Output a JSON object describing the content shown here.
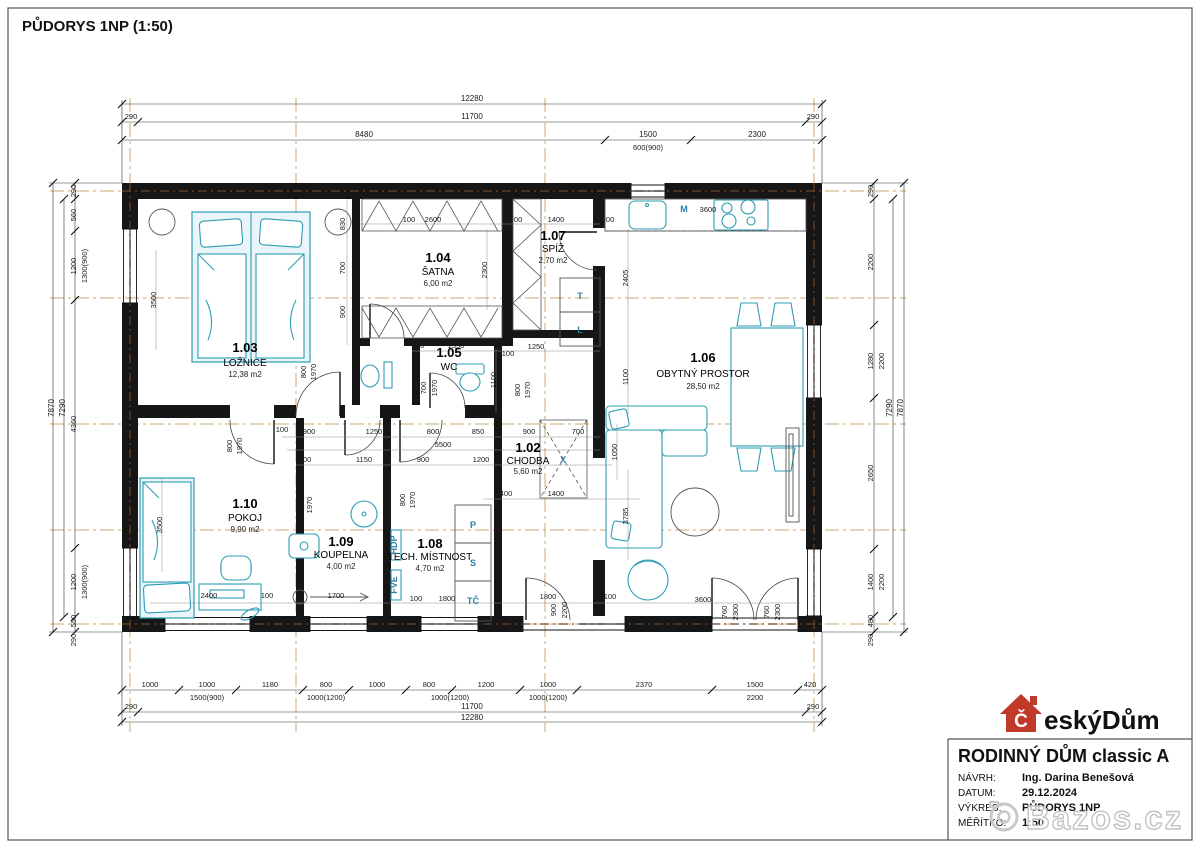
{
  "page": {
    "title": "PŮDORYS 1NP (1:50)"
  },
  "rooms": [
    {
      "num": "1.02",
      "name": "CHODBA",
      "area": "5,60 m2"
    },
    {
      "num": "1.03",
      "name": "LOŽNICE",
      "area": "12,38 m2"
    },
    {
      "num": "1.04",
      "name": "ŠATNA",
      "area": "6,00 m2"
    },
    {
      "num": "1.05",
      "name": "WC",
      "area": ""
    },
    {
      "num": "1.06",
      "name": "OBYTNÝ PROSTOR",
      "area": "28,50 m2"
    },
    {
      "num": "1.07",
      "name": "SPÍŽ",
      "area": "2,70 m2"
    },
    {
      "num": "1.08",
      "name": "TECH. MÍSTNOST",
      "area": "4,70 m2"
    },
    {
      "num": "1.09",
      "name": "KOUPELNA",
      "area": "4,00 m2"
    },
    {
      "num": "1.10",
      "name": "POKOJ",
      "area": "9,90 m2"
    }
  ],
  "equipment": {
    "m": "M",
    "t": "T",
    "l": "L",
    "p": "P",
    "s": "S",
    "tc": "TČ",
    "hdp": "HDP",
    "fve": "FVE",
    "x": "X"
  },
  "dims": {
    "top": {
      "overall": "12280",
      "side_l": "290",
      "inner": "11700",
      "side_r": "290",
      "segs": [
        "8480",
        "1500",
        "2300"
      ],
      "win": "600(900)"
    },
    "bottom": {
      "segs": [
        "1000",
        "1000",
        "1180",
        "800",
        "1000",
        "800",
        "1200",
        "1000",
        "2370",
        "1500",
        "420"
      ],
      "wins": [
        "1500(900)",
        "1000(1200)",
        "1000(1200)",
        "1000(1200)",
        "2200"
      ],
      "side_l": "290",
      "inner": "11700",
      "side_r": "290",
      "overall": "12280"
    },
    "left": {
      "segs": [
        "290",
        "560",
        "1200",
        "4360",
        "1200",
        "550",
        "290"
      ],
      "wins": [
        "1300(900)",
        "1300(900)"
      ],
      "inner": "7290",
      "overall": "7870"
    },
    "right": {
      "segs": [
        "290",
        "2200",
        "1280",
        "2650",
        "1400",
        "480",
        "290"
      ],
      "wins": [
        "2200",
        "2200"
      ],
      "inner": "7290",
      "overall": "7870"
    },
    "inner": [
      "2600",
      "1400",
      "100",
      "100",
      "100",
      "2300",
      "830",
      "700",
      "900",
      "3500",
      "3600",
      "2405",
      "1100",
      "1250",
      "100",
      "1550",
      "100",
      "1100",
      "900",
      "1250",
      "800",
      "850",
      "900",
      "700",
      "5500",
      "800",
      "1150",
      "900",
      "1200",
      "1050",
      "400",
      "1400",
      "800",
      "1970",
      "700",
      "1970",
      "800",
      "1970",
      "800",
      "1970",
      "800",
      "1970",
      "700",
      "1970",
      "900",
      "2200",
      "760",
      "2300",
      "760",
      "2300",
      "1800",
      "100",
      "1800",
      "100",
      "1700",
      "2400",
      "100",
      "3600",
      "3785",
      "3500",
      "100"
    ]
  },
  "title_block": {
    "project": "RODINNÝ DŮM classic A",
    "rows": [
      {
        "label": "NÁVRH:",
        "value": "Ing. Darina Benešová"
      },
      {
        "label": "DATUM:",
        "value": "29.12.2024"
      },
      {
        "label": "VÝKRES:",
        "value": "PŮDORYS 1NP"
      },
      {
        "label": "MĚŘÍTKO:",
        "value": "1:50"
      }
    ]
  },
  "logo": {
    "initial": "Č",
    "rest": "eskýDům",
    "brand_color": "#c0392b"
  },
  "watermark": {
    "text": "Bazos.cz"
  }
}
